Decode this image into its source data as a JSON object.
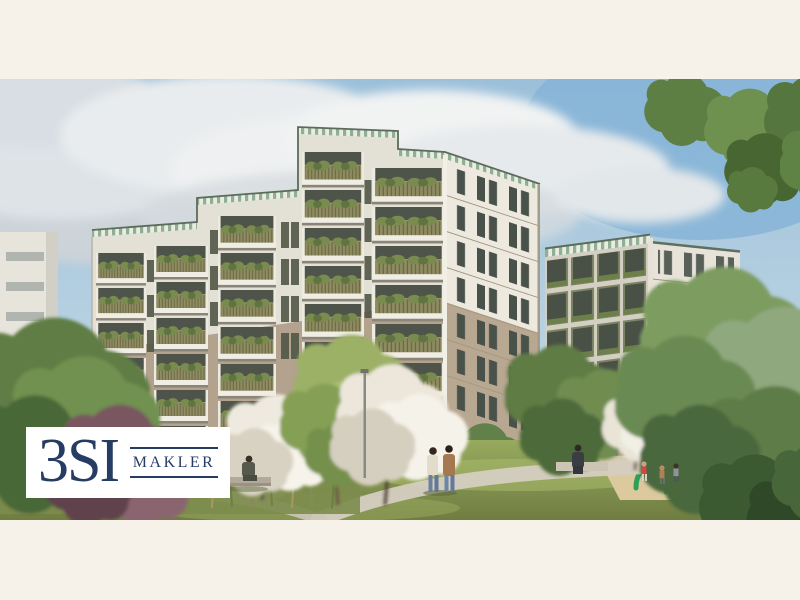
{
  "image": {
    "kind": "architectural-rendering",
    "description": "New-build residential apartment complex with planted balconies, meadow garden, blossoming trees, walking path and a children's playground on a sunny day"
  },
  "logo": {
    "brand": "3SI",
    "subtitle": "MAKLER",
    "text_color": "#273c64",
    "box_color": "#ffffff"
  },
  "palette": {
    "mat": "#f6f2e9",
    "sky": "#9cc0da",
    "cloud": "#e9edef",
    "facade_white": "#e9e5da",
    "facade_beige": "#b5a48f",
    "parapet_stripe": "#8fae94",
    "balcony_railing": "#8f8c62",
    "window_glass": "#4a5149",
    "foliage": "#6f9150",
    "blossom": "#efe9dd",
    "plum_tree": "#7a5660",
    "lawn": "#8ba152",
    "path": "#d4cec0",
    "sand": "#dcca9e",
    "play_equipment": "#2f9e57",
    "fence": "#a79271"
  }
}
